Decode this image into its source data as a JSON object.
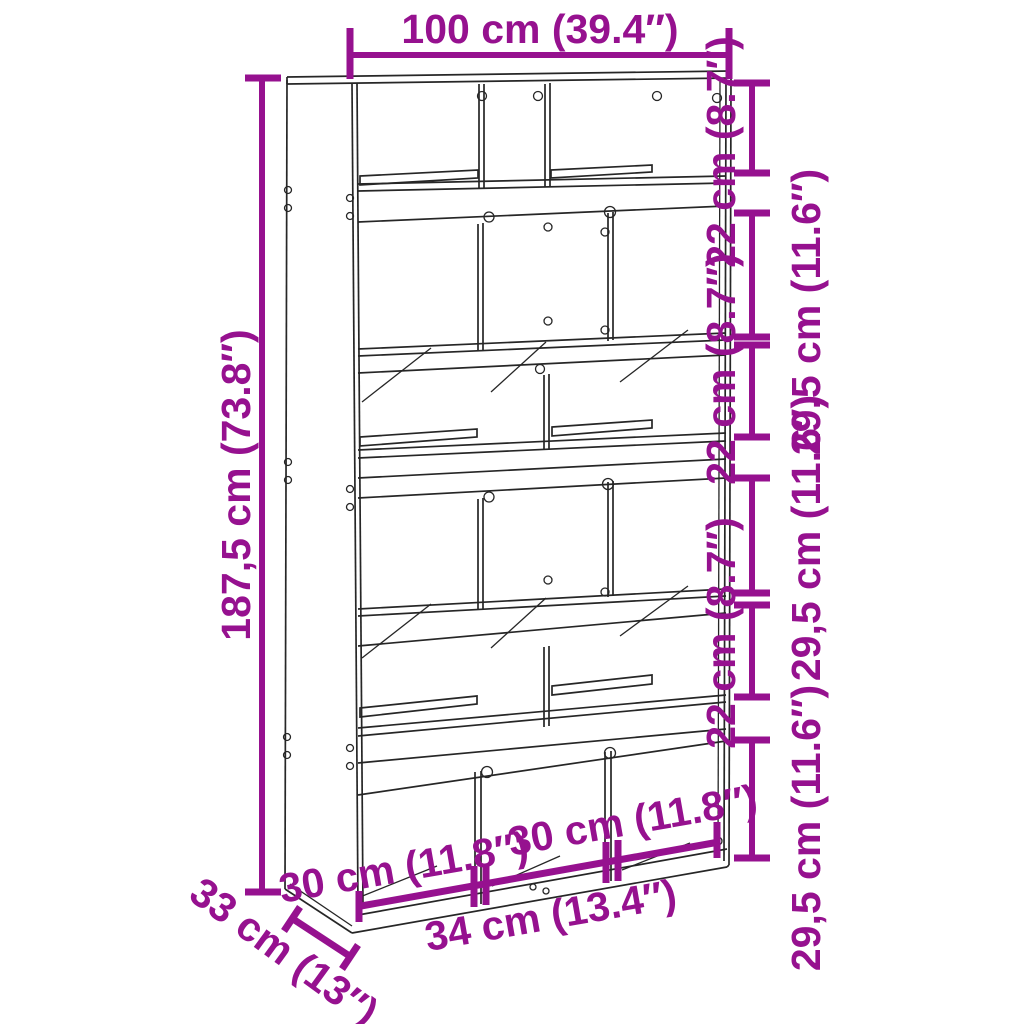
{
  "diagram": {
    "type": "furniture-dimension-diagram",
    "product": "bookcase-room-divider",
    "colors": {
      "dimension_annotation": "#96118F",
      "line_art": "#262626",
      "background": "#FFFFFF"
    },
    "labels": {
      "width_top": "100 cm (39.4″)",
      "height_left": "187,5 cm (73.8″)",
      "right_side_segments": [
        "22 cm (8.7″)",
        "29,5 cm (11.6″)",
        "22 cm (8.7″)",
        "29,5 cm (11.6″)",
        "22 cm (8.7″)",
        "29,5 cm (11.6″)"
      ],
      "bottom_section_left": "30 cm (11.8″)",
      "bottom_section_right": "30 cm (11.8″)",
      "bottom_section_middle": "34 cm (13.4″)",
      "depth": "33 cm (13″)"
    }
  }
}
